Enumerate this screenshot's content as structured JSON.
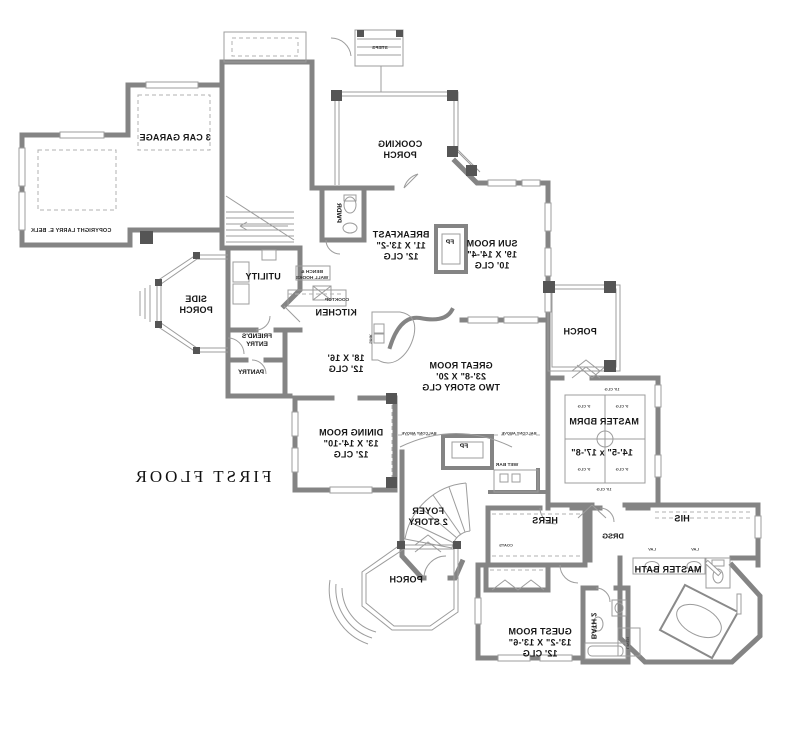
{
  "title": "FIRST FLOOR",
  "copyright": "COPYRIGHT LARRY E. BELK",
  "rooms": {
    "garage": [
      "3 CAR GARAGE"
    ],
    "cooking_porch": [
      "COOKING",
      "PORCH"
    ],
    "breakfast": [
      "BREAKFAST",
      "11' X 13'-2\"",
      "12' CLG"
    ],
    "sun_room": [
      "SUN ROOM",
      "19' X 14'-4\"",
      "10' CLG"
    ],
    "pwdr": [
      "PWDR"
    ],
    "kitchen": [
      "KITCHEN"
    ],
    "kitchen_size": [
      "18' X 16'",
      "12' CLG"
    ],
    "utility": [
      "UTILITY"
    ],
    "side_porch": [
      "SIDE",
      "PORCH"
    ],
    "friends_entry": [
      "FRIEND'S",
      "ENTRY"
    ],
    "pantry": [
      "PANTRY"
    ],
    "dining_room": [
      "DINING ROOM",
      "13' X 14'-10\"",
      "12' CLG"
    ],
    "great_room": [
      "GREAT ROOM",
      "23'-8\" X 20'",
      "TWO STORY CLG"
    ],
    "master_bdrm": [
      "MASTER BDRM"
    ],
    "master_bdrm_size": [
      "14'-5\" x 17'-8\""
    ],
    "porch_right": [
      "PORCH"
    ],
    "foyer": [
      "FOYER",
      "2 STORY"
    ],
    "hers": [
      "HERS"
    ],
    "his": [
      "HIS"
    ],
    "drsg": [
      "DRSG"
    ],
    "master_bath": [
      "MASTER BATH"
    ],
    "bath_2": [
      "BATH 2"
    ],
    "guest_room": [
      "GUEST ROOM",
      "13'-2\" X 13'-6\"",
      "12' CLG"
    ],
    "porch_front": [
      "PORCH"
    ]
  },
  "annotations": {
    "fp": "FP",
    "wet_bar": "WET BAR",
    "coats": "COATS",
    "linen": "LINEN",
    "lav": "LAV",
    "steps": "STEPS",
    "cooktop": "COOKTOP",
    "sink": "SINK",
    "bench": [
      "BENCH &",
      "WALL HOOKS"
    ],
    "balcony_above": "BALCONY ABOVE",
    "clg_9": "9' CLG",
    "clg_10": "10' CLG"
  }
}
